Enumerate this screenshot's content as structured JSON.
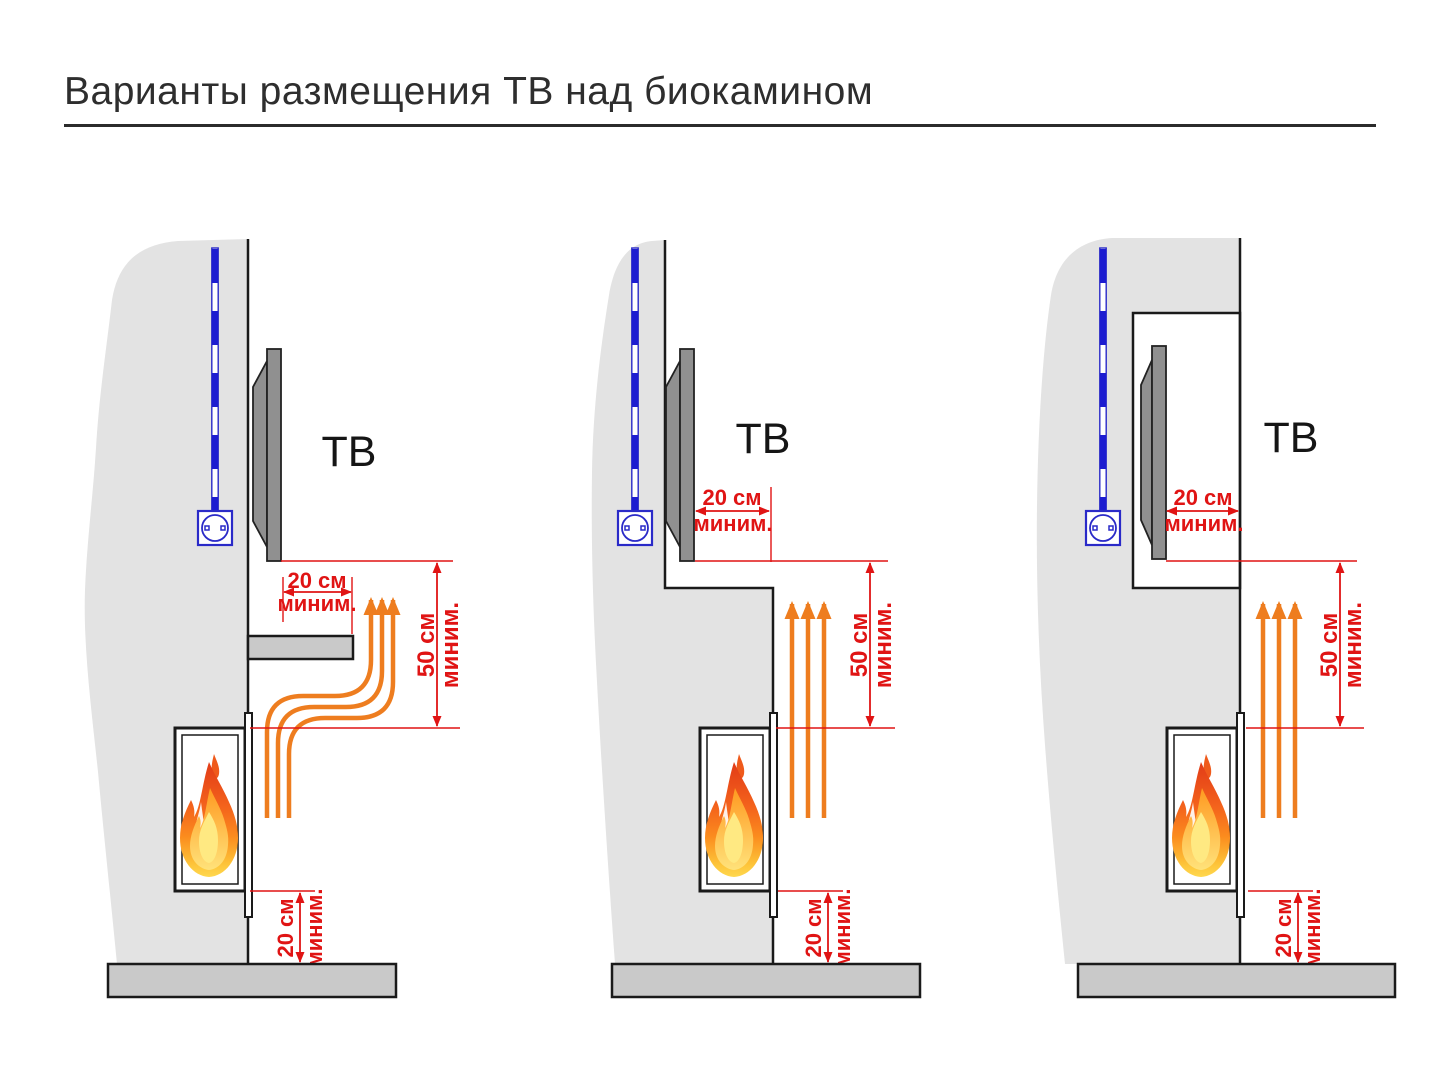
{
  "title": "Варианты размещения ТВ над биокамином",
  "panels": [
    {
      "id": "tv-on-wall-above-shelf",
      "tv_label": "ТВ",
      "dim_gap": {
        "value": "20 см",
        "qualifier": "миним."
      },
      "dim_height": {
        "value": "50 см",
        "qualifier": "миним."
      },
      "dim_floor": {
        "value": "20 см",
        "qualifier": "миним."
      }
    },
    {
      "id": "tv-on-recessed-wall-step",
      "tv_label": "ТВ",
      "dim_gap": {
        "value": "20 см",
        "qualifier": "миним."
      },
      "dim_height": {
        "value": "50 см",
        "qualifier": "миним."
      },
      "dim_floor": {
        "value": "20 см",
        "qualifier": "миним."
      }
    },
    {
      "id": "tv-in-wall-niche",
      "tv_label": "ТВ",
      "dim_gap": {
        "value": "20 см",
        "qualifier": "миним."
      },
      "dim_height": {
        "value": "50 см",
        "qualifier": "миним."
      },
      "dim_floor": {
        "value": "20 см",
        "qualifier": "миним."
      }
    }
  ],
  "colors": {
    "dimension_red": "#e01414",
    "heat_orange": "#ee7d1f",
    "cable_blue": "#1d1dd0",
    "socket_blue": "#2a2ac8",
    "wall_gray": "#e3e3e3",
    "slab_gray": "#c9c9c9",
    "tv_gray": "#909090",
    "flame_red": "#e23b17",
    "flame_yellow": "#ffd84e"
  }
}
